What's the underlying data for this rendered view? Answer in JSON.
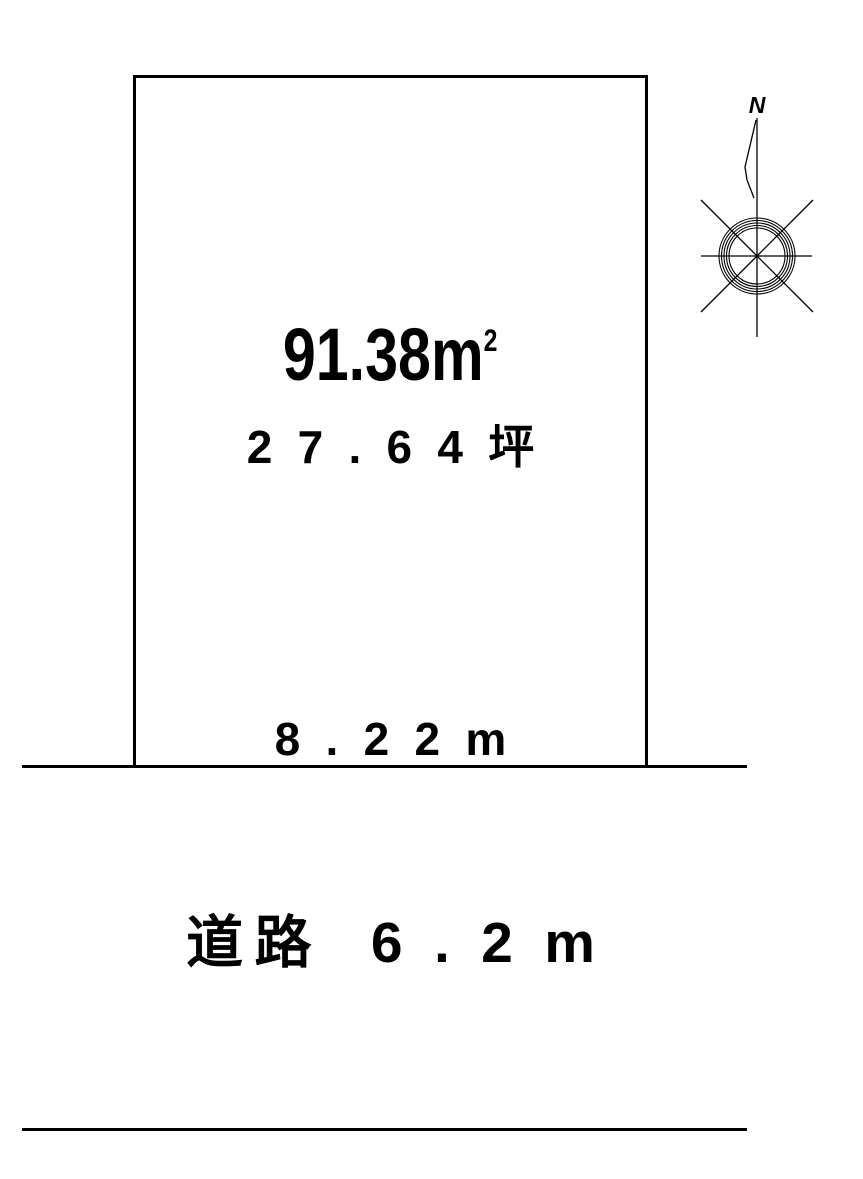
{
  "page": {
    "background": "#ffffff",
    "ink": "#000000"
  },
  "plot": {
    "area_sqm_value": "91.38",
    "area_sqm_unit": "m",
    "area_sqm_exponent": "2",
    "area_tsubo": "27.64坪",
    "frontage": "8.22m"
  },
  "road": {
    "label": "道路",
    "width": "6.2m"
  },
  "compass": {
    "north_label": "N"
  }
}
